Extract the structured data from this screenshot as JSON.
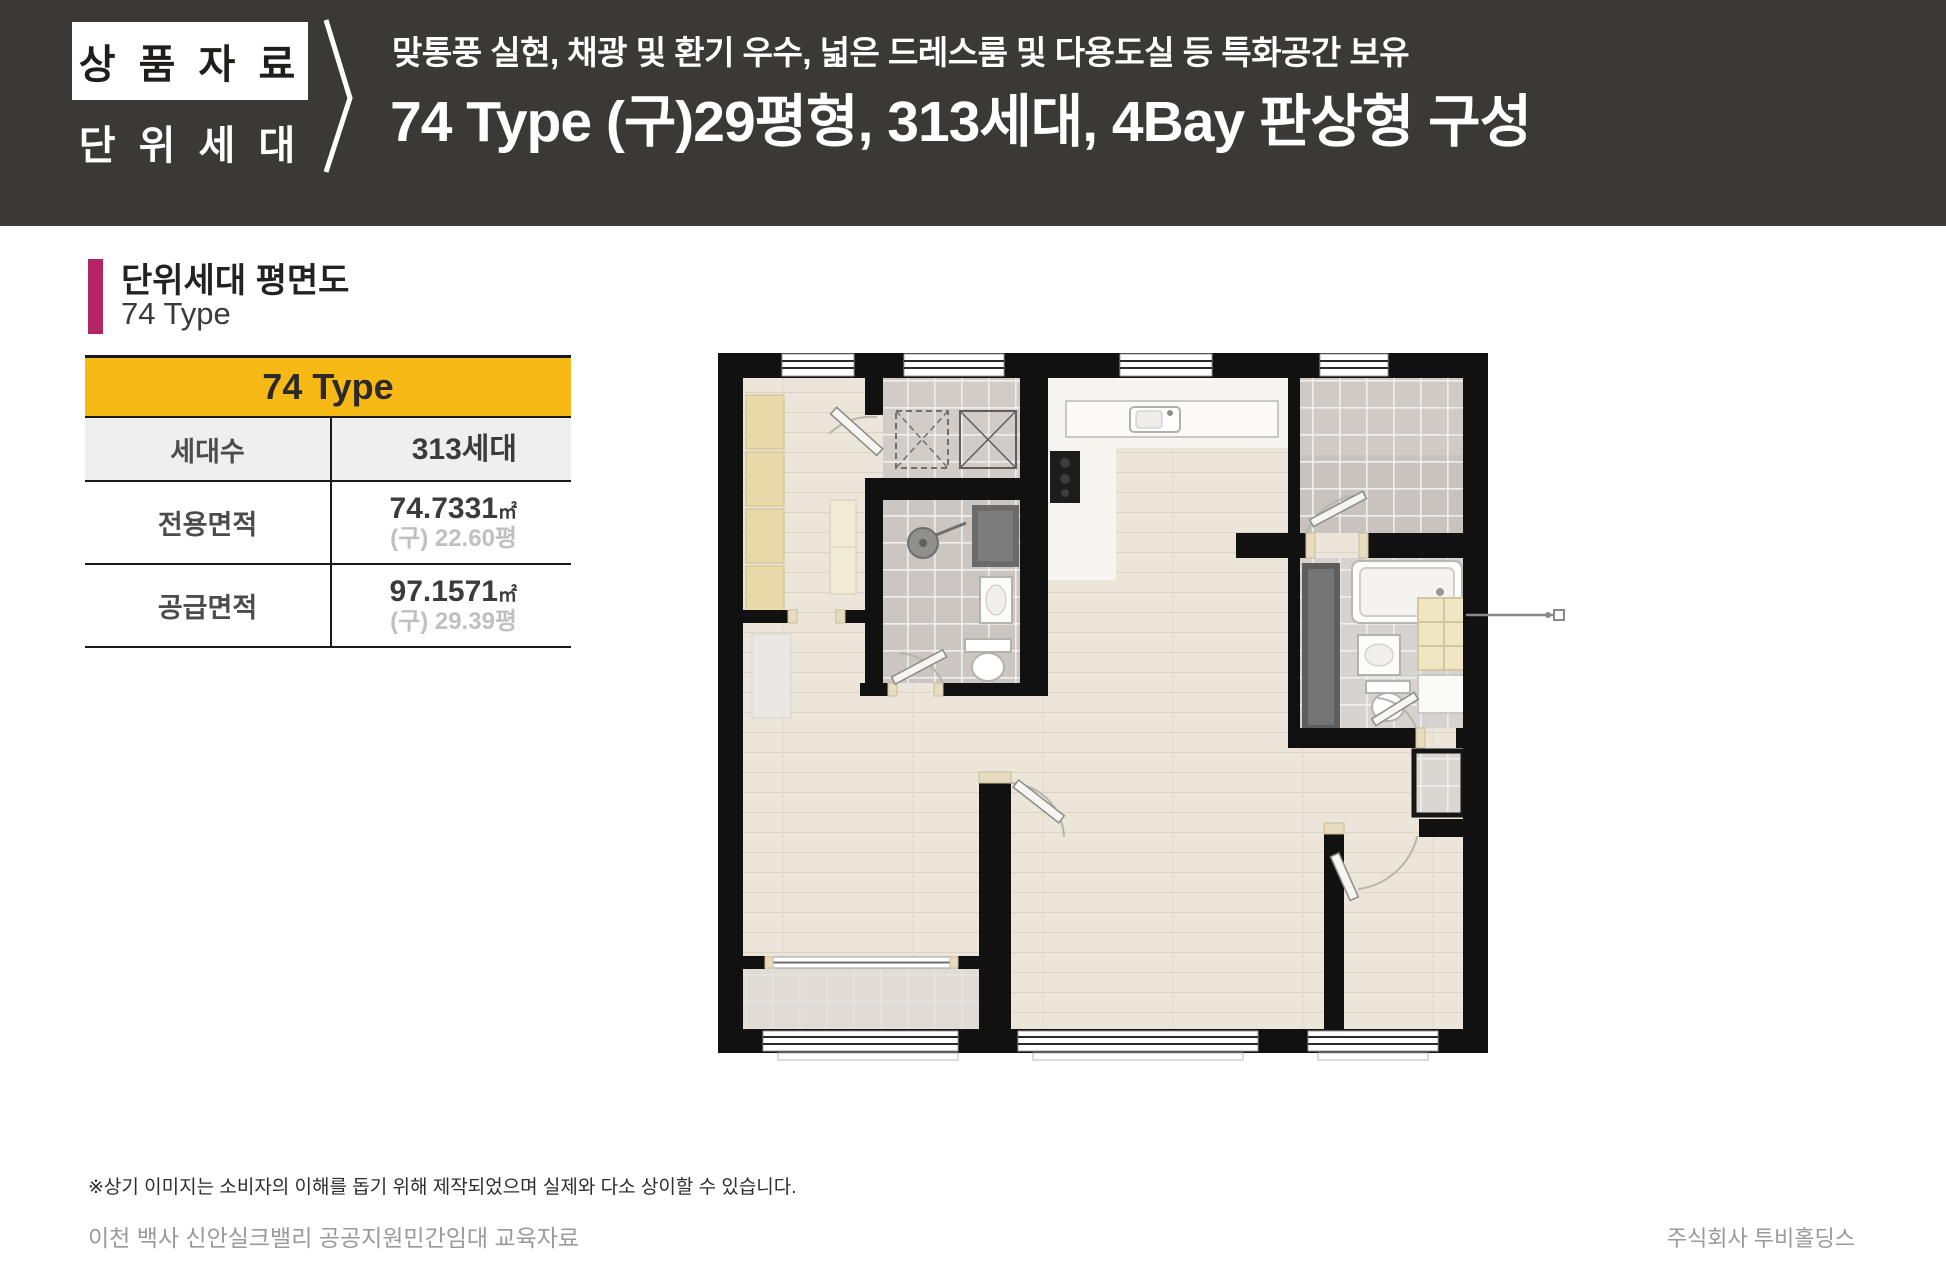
{
  "header": {
    "badge_top": "상 품 자 료",
    "badge_bottom": "단 위 세 대",
    "subtitle": "맞통풍 실현, 채광 및 환기 우수, 넓은 드레스룸 및 다용도실 등 특화공간 보유",
    "title": "74 Type (구)29평형, 313세대, 4Bay 판상형 구성"
  },
  "section": {
    "title": "단위세대 평면도",
    "subtitle": "74 Type"
  },
  "spec_table": {
    "header": "74 Type",
    "rows": [
      {
        "label": "세대수",
        "value": "313세대"
      },
      {
        "label": "전용면적",
        "value": "74.7331",
        "unit": "㎡",
        "sub": "(구) 22.60평"
      },
      {
        "label": "공급면적",
        "value": "97.1571",
        "unit": "㎡",
        "sub": "(구) 29.39평"
      }
    ]
  },
  "footer": {
    "disclaimer": "※상기 이미지는 소비자의 이해를 돕기 위해 제작되었으며 실제와 다소 상이할 수 있습니다.",
    "left": "이천 백사 신안실크밸리 공공지원민간임대 교육자료",
    "right": "주식회사 투비홀딩스"
  },
  "colors": {
    "header_bg": "#3a3937",
    "accent_yellow": "#f7b915",
    "accent_magenta": "#b52563",
    "wall_black": "#111111",
    "wood_floor": "#ebe6d9",
    "tile_gray": "#cfc9c5"
  }
}
